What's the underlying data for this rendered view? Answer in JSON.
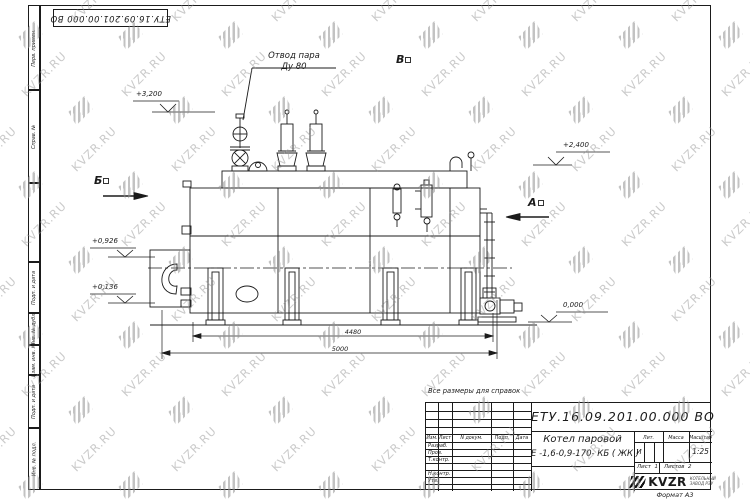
{
  "sheet": {
    "stamp_top": "ЕТУ.16.09.201.00.000  ВО",
    "note": "Все размеры для справок",
    "format_label": "Формат А3"
  },
  "frame": {
    "left_top": [
      "Перв. примен.",
      "Справ. №"
    ],
    "left_bottom": [
      "Подп. и дата",
      "Инв. № дубл.",
      "Взам. инв. №",
      "Подп. и дата",
      "Инв. № подл."
    ]
  },
  "watermark": {
    "text": "KVZR.RU"
  },
  "drawing": {
    "callout": {
      "line1": "Отвод пара",
      "line2": "Ду 80"
    },
    "views": {
      "b": "Б",
      "v": "В",
      "a": "А"
    },
    "elevations": {
      "top": "+3,200",
      "right_upper": "+2,400",
      "left_upper": "+0,926",
      "left_lower": "+0,136",
      "ground": "0,000"
    },
    "dimensions": {
      "inner": "4480",
      "overall": "5000"
    }
  },
  "title_block": {
    "doc_number": "ЕТУ.16.09.201.00.000  ВО",
    "name_line1": "Котел паровой",
    "name_line2": "Е -1,6-0,9-170- КБ ( ЖК )",
    "col_izm": "Изм.",
    "col_list": "Лист",
    "col_ndokum": "N докум.",
    "col_podp": "Подп.",
    "col_data": "Дата",
    "row_razrab": "Разраб.",
    "row_prov": "Пров.",
    "row_tkontr": "Т.контр.",
    "row_nkontr": "Н.контр.",
    "row_utv": "Утв.",
    "lit_label": "Лит.",
    "massa_label": "Масса",
    "masshtab_label": "Масштаб",
    "lit_value": "И",
    "scale_value": "1:25",
    "list_label": "Лист",
    "list_value": "1",
    "listov_label": "Листов",
    "listov_value": "2",
    "logo_text": "KVZR",
    "logo_sub1": "КОТЕЛЬНЫЙ",
    "logo_sub2": "ЗАВОД РЭУ"
  }
}
